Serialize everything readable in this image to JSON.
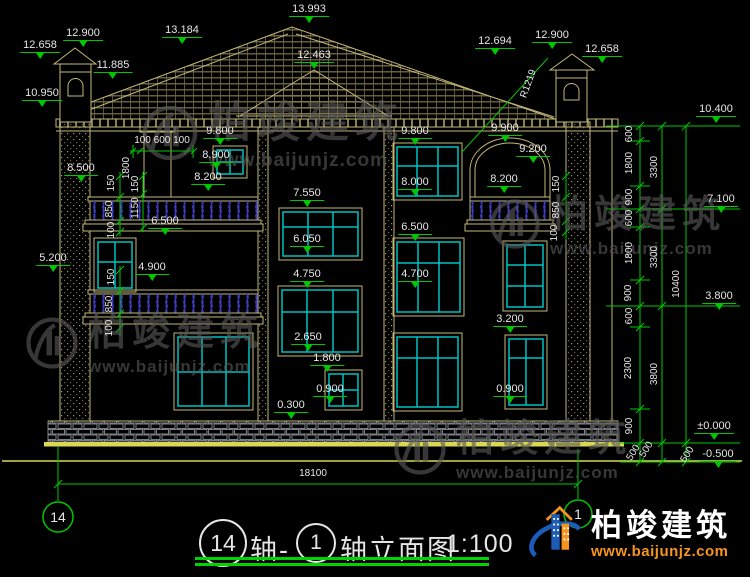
{
  "brand": {
    "name": "柏竣建筑",
    "url": "www.baijunjz.com"
  },
  "drawing": {
    "title": {
      "axis_left": "14",
      "prefix_word": "轴-",
      "axis_right": "1",
      "name": "轴立面图",
      "scale": "1:100"
    },
    "axis_bubble_left": "14",
    "axis_bubble_right": "1"
  },
  "colors": {
    "dim_green": "#00c800",
    "outline_tan": "#c2b878",
    "window_teal": "#00c2c2",
    "railing_blue": "#4a4ad8",
    "ground_yellow": "#d8d852",
    "text": "#e6e6e6",
    "logo_blue": "#1d5bb8",
    "logo_orange": "#f7941d"
  },
  "labels": {
    "elevation": [
      {
        "text": "12.658",
        "x": 40,
        "y": 40
      },
      {
        "text": "12.900",
        "x": 83,
        "y": 28
      },
      {
        "text": "13.184",
        "x": 182,
        "y": 25
      },
      {
        "text": "13.993",
        "x": 309,
        "y": 4
      },
      {
        "text": "11.885",
        "x": 113,
        "y": 60
      },
      {
        "text": "10.950",
        "x": 42,
        "y": 88
      },
      {
        "text": "12.463",
        "x": 314,
        "y": 50
      },
      {
        "text": "12.694",
        "x": 495,
        "y": 36
      },
      {
        "text": "12.900",
        "x": 552,
        "y": 30
      },
      {
        "text": "12.658",
        "x": 602,
        "y": 44
      },
      {
        "text": "9.800",
        "x": 220,
        "y": 126
      },
      {
        "text": "8.900",
        "x": 216,
        "y": 150
      },
      {
        "text": "8.200",
        "x": 208,
        "y": 172
      },
      {
        "text": "8.500",
        "x": 81,
        "y": 163
      },
      {
        "text": "6.500",
        "x": 165,
        "y": 216
      },
      {
        "text": "4.900",
        "x": 152,
        "y": 262
      },
      {
        "text": "5.200",
        "x": 53,
        "y": 253
      },
      {
        "text": "7.550",
        "x": 307,
        "y": 188
      },
      {
        "text": "6.050",
        "x": 307,
        "y": 234
      },
      {
        "text": "4.750",
        "x": 307,
        "y": 269
      },
      {
        "text": "2.650",
        "x": 308,
        "y": 332
      },
      {
        "text": "1.800",
        "x": 327,
        "y": 353
      },
      {
        "text": "0.900",
        "x": 330,
        "y": 384
      },
      {
        "text": "0.300",
        "x": 291,
        "y": 400
      },
      {
        "text": "9.800",
        "x": 415,
        "y": 126
      },
      {
        "text": "8.000",
        "x": 415,
        "y": 177
      },
      {
        "text": "6.500",
        "x": 415,
        "y": 222
      },
      {
        "text": "4.700",
        "x": 415,
        "y": 269
      },
      {
        "text": "9.900",
        "x": 505,
        "y": 123
      },
      {
        "text": "9.200",
        "x": 533,
        "y": 144
      },
      {
        "text": "8.200",
        "x": 504,
        "y": 174
      },
      {
        "text": "3.200",
        "x": 510,
        "y": 314
      },
      {
        "text": "0.900",
        "x": 510,
        "y": 384
      },
      {
        "text": "10.400",
        "x": 716,
        "y": 104
      },
      {
        "text": "7.100",
        "x": 721,
        "y": 194
      },
      {
        "text": "3.800",
        "x": 719,
        "y": 291
      },
      {
        "text": "±0.000",
        "x": 714,
        "y": 421
      },
      {
        "text": "-0.500",
        "x": 718,
        "y": 449
      }
    ],
    "dims_h": [
      {
        "text": "100 600 100",
        "x": 162,
        "y": 136
      },
      {
        "text": "18100",
        "x": 313,
        "y": 469
      }
    ],
    "dims_v": [
      {
        "text": "1800",
        "x": 127,
        "y": 168
      },
      {
        "text": "150",
        "x": 112,
        "y": 183
      },
      {
        "text": "850",
        "x": 110,
        "y": 209
      },
      {
        "text": "100",
        "x": 112,
        "y": 230
      },
      {
        "text": "150",
        "x": 136,
        "y": 184
      },
      {
        "text": "1150",
        "x": 136,
        "y": 208
      },
      {
        "text": "150",
        "x": 112,
        "y": 277
      },
      {
        "text": "850",
        "x": 110,
        "y": 304
      },
      {
        "text": "100",
        "x": 110,
        "y": 328
      },
      {
        "text": "150",
        "x": 557,
        "y": 184
      },
      {
        "text": "850",
        "x": 557,
        "y": 210
      },
      {
        "text": "100",
        "x": 555,
        "y": 233
      },
      {
        "text": "600",
        "x": 630,
        "y": 134
      },
      {
        "text": "1800",
        "x": 630,
        "y": 163
      },
      {
        "text": "900",
        "x": 630,
        "y": 197
      },
      {
        "text": "600",
        "x": 630,
        "y": 218
      },
      {
        "text": "1800",
        "x": 630,
        "y": 253
      },
      {
        "text": "900",
        "x": 629,
        "y": 293
      },
      {
        "text": "600",
        "x": 630,
        "y": 316
      },
      {
        "text": "2300",
        "x": 629,
        "y": 368
      },
      {
        "text": "900",
        "x": 630,
        "y": 426
      },
      {
        "text": "3300",
        "x": 655,
        "y": 167
      },
      {
        "text": "3300",
        "x": 655,
        "y": 257
      },
      {
        "text": "3800",
        "x": 655,
        "y": 374
      },
      {
        "text": "10400",
        "x": 677,
        "y": 284
      }
    ],
    "dims_rot": [
      {
        "text": "500",
        "x": 647,
        "y": 450,
        "a": -58
      },
      {
        "text": "500",
        "x": 634,
        "y": 453,
        "a": -58
      },
      {
        "text": "500",
        "x": 688,
        "y": 455,
        "a": -58
      },
      {
        "text": "R1219",
        "x": 529,
        "y": 84,
        "a": -70
      }
    ]
  }
}
